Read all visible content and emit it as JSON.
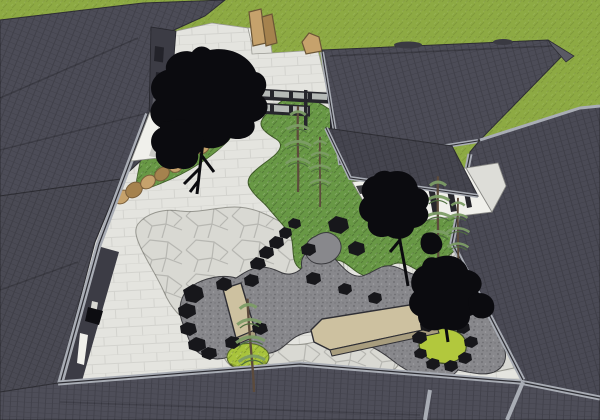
{
  "scene": {
    "type": "3d-architectural-render",
    "view": "aerial axonometric",
    "subject": "Japanese-style courtyard garden enclosed by dark-roofed buildings",
    "style": "SketchUp-like model render",
    "has_text": false
  },
  "palette": {
    "ground_green": "#8DAA43",
    "roof_dark": "#4C4C57",
    "roof_darker": "#45454F",
    "roof_medium": "#4A4A54",
    "roof_bottom": "#4E4E59",
    "roof_right": "#4A4A55",
    "roof_hip_light": "#5A5A64",
    "ridge_cap": "#3A3A42",
    "fascia_gray": "#A9ADB5",
    "wall_dark": "#3C3C45",
    "wall_white": "#F0F0EB",
    "wall_shadow_white": "#C9C9C4",
    "paving_light": "#E4E4DF",
    "step_light": "#EFEFEA",
    "step_shadow": "#E0E0DA",
    "flagstone_light": "#D9D9D3",
    "gravel_gray": "#88888C",
    "lawn_green": "#689845",
    "mound_green": "#A8C43C",
    "pond_green": "#B2C83D",
    "rock_black": "#17171B",
    "stone_tan": "#C6A26C",
    "stone_tan_dark": "#A5824E",
    "bridge_tan": "#CDC1A0",
    "bridge_shadow": "#A89D7E",
    "tree_black": "#0B0B0F",
    "pine_green": "#7C9C66",
    "pine_trunk": "#5C4B3C",
    "window_pane": "#B5B9B6",
    "frame_dark": "#26262C",
    "outline_dark": "#2E2E34"
  },
  "elements": [
    {
      "name": "entry-court-paving",
      "type": "surface",
      "color_ref": "paving_light"
    },
    {
      "name": "flagstone-paths",
      "type": "surface",
      "color_ref": "flagstone_light"
    },
    {
      "name": "dry-gravel-stream",
      "type": "surface",
      "color_ref": "gravel_gray"
    },
    {
      "name": "central-lawn",
      "type": "planting",
      "color_ref": "lawn_green"
    },
    {
      "name": "upper-lawn-patch",
      "type": "planting",
      "color_ref": "lawn_green"
    },
    {
      "name": "moss-mound",
      "type": "planting",
      "color_ref": "mound_green"
    },
    {
      "name": "small-pond",
      "type": "water",
      "color_ref": "pond_green"
    },
    {
      "name": "stone-slab-bridge-small",
      "type": "feature",
      "color_ref": "bridge_tan"
    },
    {
      "name": "stone-slab-bridge-long",
      "type": "feature",
      "color_ref": "bridge_tan"
    },
    {
      "name": "standing-stones",
      "type": "feature",
      "color_ref": "stone_tan"
    },
    {
      "name": "stone-edging-arc",
      "type": "feature",
      "color_ref": "stone_tan"
    },
    {
      "name": "scattered-rocks",
      "type": "feature",
      "color_ref": "rock_black"
    },
    {
      "name": "deciduous-tree-silhouettes",
      "type": "vegetation",
      "color_ref": "tree_black",
      "count": 3
    },
    {
      "name": "pine-trees",
      "type": "vegetation",
      "color_ref": "pine_green",
      "count": 5
    },
    {
      "name": "north-west-building",
      "type": "building"
    },
    {
      "name": "glazed-screen-wall",
      "type": "building"
    },
    {
      "name": "north-east-building",
      "type": "building"
    },
    {
      "name": "east-building",
      "type": "building"
    },
    {
      "name": "south-building",
      "type": "building"
    },
    {
      "name": "garden-pavilion",
      "type": "building"
    }
  ]
}
